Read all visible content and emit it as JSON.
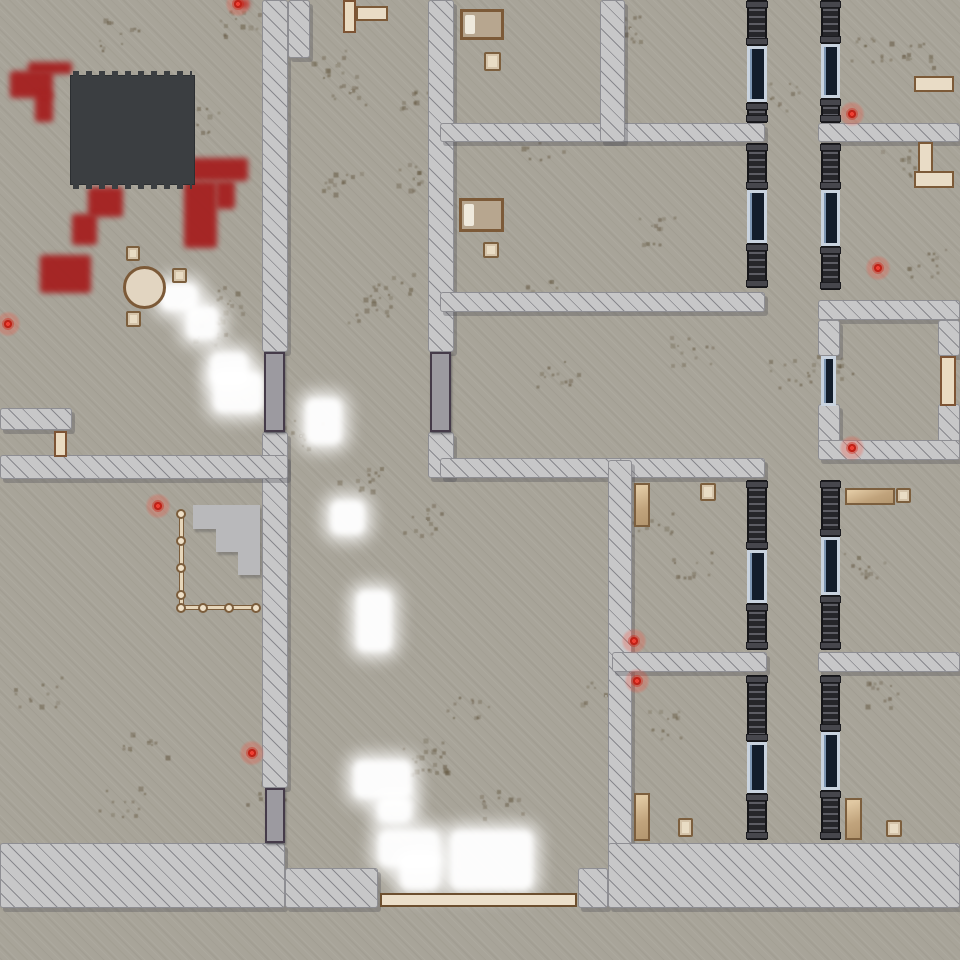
{
  "map": {
    "size": [
      960,
      960
    ],
    "colors": {
      "ground": "#a8a499",
      "wall": "#c7c7c8",
      "wall_hatch": "#4a4a52",
      "blood": "#a51d1d",
      "roof": "#3b3e41",
      "display_navy": "#131d2b",
      "display_frame": "#c9d3df",
      "metal_door": "#9c9aa0",
      "metal_door_frame": "#453b49",
      "wood": "#eadbc1",
      "wood_frame": "#7d5434",
      "locker_tan": "#c0a37c",
      "light_glow": "#ffffff",
      "marker_red": "#d42a1e",
      "shelf_dark": "#26262a"
    },
    "walls": [
      [
        262,
        0,
        26,
        352
      ],
      [
        288,
        0,
        22,
        58
      ],
      [
        262,
        432,
        26,
        356
      ],
      [
        428,
        0,
        26,
        352
      ],
      [
        428,
        432,
        26,
        46
      ],
      [
        0,
        408,
        72,
        22
      ],
      [
        0,
        455,
        288,
        24
      ],
      [
        440,
        123,
        325,
        19
      ],
      [
        818,
        123,
        142,
        19
      ],
      [
        600,
        0,
        25,
        142
      ],
      [
        440,
        292,
        325,
        20
      ],
      [
        440,
        458,
        325,
        20
      ],
      [
        608,
        460,
        24,
        390
      ],
      [
        612,
        652,
        155,
        20
      ],
      [
        818,
        652,
        142,
        20
      ],
      [
        818,
        300,
        142,
        20
      ],
      [
        818,
        320,
        22,
        36
      ],
      [
        818,
        404,
        22,
        38
      ],
      [
        938,
        320,
        22,
        36
      ],
      [
        938,
        404,
        22,
        38
      ],
      [
        818,
        440,
        142,
        20
      ],
      [
        0,
        843,
        285,
        65
      ],
      [
        285,
        868,
        93,
        40
      ],
      [
        578,
        868,
        30,
        40
      ],
      [
        608,
        843,
        352,
        65
      ]
    ],
    "metal_doors": [
      [
        264,
        352,
        21,
        80
      ],
      [
        430,
        352,
        21,
        80
      ],
      [
        265,
        788,
        20,
        55
      ]
    ],
    "wood_doors": [
      [
        54,
        431,
        13,
        26
      ],
      [
        940,
        356,
        16,
        50
      ],
      [
        343,
        0,
        13,
        33
      ]
    ],
    "windows": [
      [
        821,
        356,
        15,
        50
      ]
    ],
    "display_cases": [
      [
        747,
        46,
        20,
        56
      ],
      [
        747,
        190,
        20,
        53
      ],
      [
        747,
        550,
        20,
        53
      ],
      [
        747,
        742,
        20,
        51
      ],
      [
        821,
        44,
        19,
        54
      ],
      [
        821,
        190,
        19,
        56
      ],
      [
        821,
        537,
        19,
        58
      ],
      [
        821,
        732,
        19,
        58
      ]
    ],
    "shelves": [
      [
        747,
        0,
        20,
        46
      ],
      [
        747,
        102,
        20,
        21
      ],
      [
        747,
        143,
        20,
        47
      ],
      [
        747,
        243,
        20,
        45
      ],
      [
        747,
        480,
        20,
        70
      ],
      [
        747,
        603,
        20,
        47
      ],
      [
        747,
        675,
        20,
        67
      ],
      [
        747,
        793,
        20,
        47
      ],
      [
        821,
        0,
        19,
        44
      ],
      [
        821,
        98,
        19,
        25
      ],
      [
        821,
        143,
        19,
        47
      ],
      [
        821,
        246,
        19,
        44
      ],
      [
        821,
        480,
        19,
        57
      ],
      [
        821,
        595,
        19,
        55
      ],
      [
        821,
        675,
        19,
        57
      ],
      [
        821,
        790,
        19,
        50
      ]
    ],
    "beds": [
      [
        460,
        9,
        44,
        31
      ],
      [
        459,
        198,
        45,
        34
      ]
    ],
    "nightstands": [
      [
        484,
        52,
        17,
        19
      ],
      [
        483,
        242,
        16,
        16
      ]
    ],
    "chairs": [
      [
        126,
        246,
        14,
        15
      ],
      [
        172,
        268,
        15,
        15
      ],
      [
        126,
        311,
        15,
        16
      ],
      [
        700,
        483,
        16,
        18
      ],
      [
        678,
        818,
        15,
        19
      ],
      [
        896,
        488,
        15,
        15
      ],
      [
        886,
        820,
        16,
        17
      ]
    ],
    "lockers_v": [
      [
        634,
        483,
        16,
        44
      ],
      [
        634,
        793,
        16,
        48
      ],
      [
        845,
        798,
        17,
        42
      ]
    ],
    "lockers_h": [
      [
        845,
        488,
        50,
        17
      ]
    ],
    "tables": [
      [
        914,
        76,
        40,
        16
      ],
      [
        918,
        142,
        15,
        31
      ],
      [
        914,
        171,
        40,
        17
      ],
      [
        356,
        6,
        32,
        15
      ]
    ],
    "round_tables": [
      [
        123,
        266,
        43,
        43
      ]
    ],
    "counters": [
      [
        380,
        893,
        197,
        14
      ]
    ],
    "platforms": [
      [
        193,
        505,
        67,
        24
      ],
      [
        216,
        529,
        44,
        23
      ],
      [
        238,
        552,
        22,
        23
      ]
    ],
    "roofs": [
      [
        70,
        75,
        125,
        110
      ]
    ],
    "fence": {
      "rails": [
        [
          179,
          512,
          5,
          98
        ],
        [
          179,
          605,
          80,
          5
        ]
      ],
      "posts": [
        [
          181,
          514
        ],
        [
          181,
          541
        ],
        [
          181,
          568
        ],
        [
          181,
          595
        ],
        [
          181,
          608
        ],
        [
          203,
          608
        ],
        [
          229,
          608
        ],
        [
          256,
          608
        ]
      ]
    },
    "blood": [
      [
        28,
        62,
        44,
        12
      ],
      [
        10,
        71,
        43,
        27
      ],
      [
        35,
        93,
        18,
        29
      ],
      [
        88,
        187,
        35,
        30
      ],
      [
        72,
        214,
        25,
        31
      ],
      [
        40,
        255,
        51,
        38
      ],
      [
        190,
        158,
        58,
        23
      ],
      [
        184,
        181,
        33,
        67
      ],
      [
        216,
        181,
        19,
        28
      ],
      [
        237,
        0,
        12,
        8
      ]
    ],
    "lights": [
      [
        160,
        283,
        38,
        28
      ],
      [
        186,
        306,
        33,
        34
      ],
      [
        210,
        352,
        38,
        32
      ],
      [
        213,
        372,
        50,
        41
      ],
      [
        305,
        398,
        37,
        47
      ],
      [
        330,
        500,
        35,
        35
      ],
      [
        356,
        590,
        36,
        62
      ],
      [
        353,
        760,
        59,
        39
      ],
      [
        377,
        797,
        35,
        26
      ],
      [
        378,
        830,
        62,
        37
      ],
      [
        400,
        855,
        40,
        35
      ],
      [
        450,
        830,
        83,
        60
      ]
    ],
    "markers": [
      [
        8,
        324
      ],
      [
        158,
        506
      ],
      [
        238,
        4
      ],
      [
        252,
        753
      ],
      [
        634,
        641
      ],
      [
        637,
        681
      ],
      [
        852,
        114
      ],
      [
        852,
        448
      ],
      [
        878,
        268
      ]
    ],
    "dirt": [
      [
        120,
        35
      ],
      [
        195,
        118
      ],
      [
        240,
        22
      ],
      [
        335,
        62
      ],
      [
        350,
        90
      ],
      [
        410,
        95
      ],
      [
        340,
        185
      ],
      [
        415,
        178
      ],
      [
        390,
        285
      ],
      [
        370,
        310
      ],
      [
        630,
        28
      ],
      [
        655,
        232
      ],
      [
        782,
        95
      ],
      [
        868,
        48
      ],
      [
        543,
        145
      ],
      [
        560,
        372
      ],
      [
        690,
        350
      ],
      [
        790,
        375
      ],
      [
        930,
        262
      ],
      [
        862,
        565
      ],
      [
        652,
        525
      ],
      [
        690,
        565
      ],
      [
        605,
        695
      ],
      [
        660,
        725
      ],
      [
        230,
        302
      ],
      [
        215,
        332
      ],
      [
        360,
        482
      ],
      [
        425,
        520
      ],
      [
        300,
        435
      ],
      [
        470,
        705
      ],
      [
        425,
        755
      ],
      [
        262,
        792
      ],
      [
        905,
        162
      ],
      [
        880,
        695
      ],
      [
        38,
        692
      ],
      [
        122,
        802
      ],
      [
        145,
        745
      ],
      [
        430,
        760
      ],
      [
        500,
        805
      ],
      [
        545,
        295
      ],
      [
        830,
        368
      ],
      [
        912,
        55
      ]
    ]
  }
}
